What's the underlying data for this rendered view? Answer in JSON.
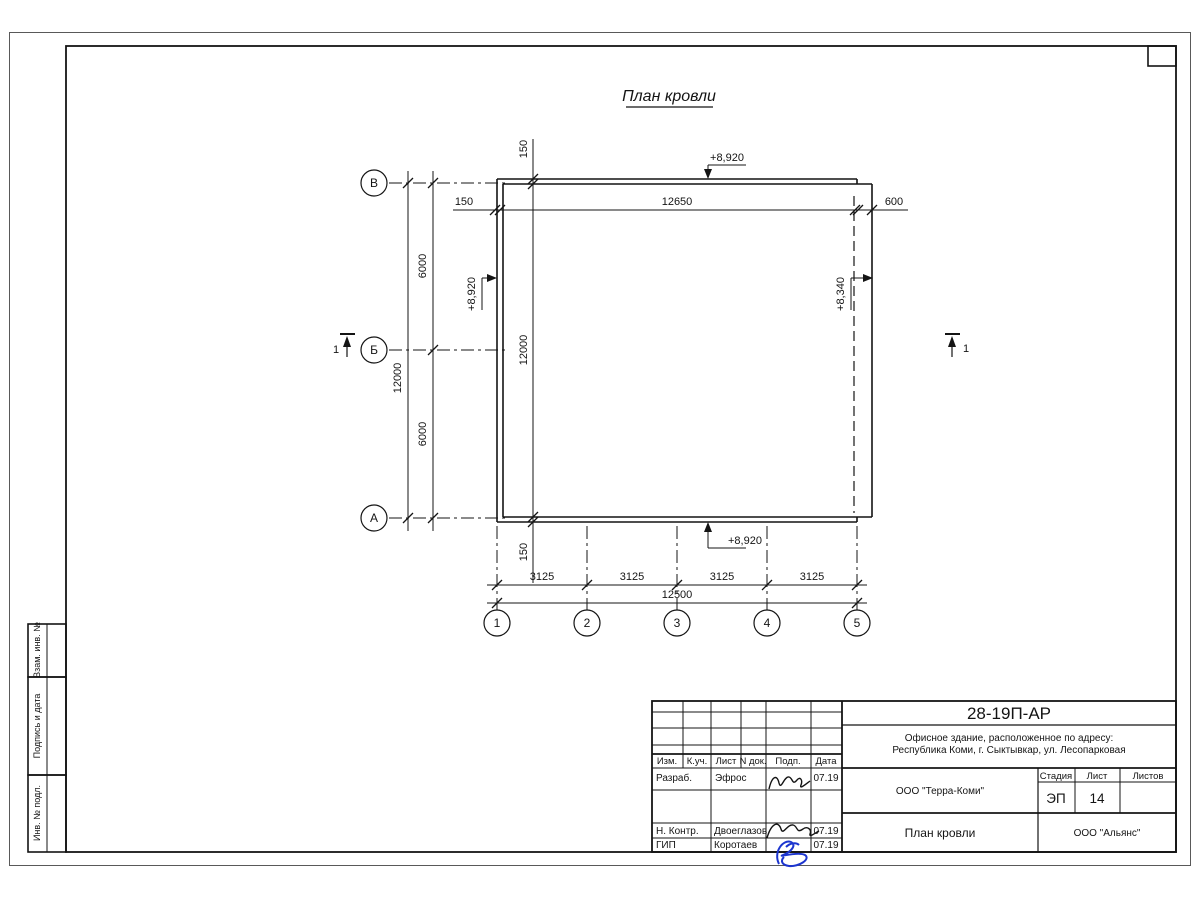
{
  "drawing": {
    "title": "План кровли",
    "row_axes": [
      "В",
      "Б",
      "А"
    ],
    "col_axes": [
      "1",
      "2",
      "3",
      "4",
      "5"
    ],
    "dims": {
      "top": [
        "150",
        "12650",
        "600"
      ],
      "chain": [
        "150",
        "12000",
        "150"
      ],
      "left_spans": [
        "6000",
        "6000"
      ],
      "left_total": "12000",
      "bottom_spans": [
        "3125",
        "3125",
        "3125",
        "3125"
      ],
      "bottom_total": "12500"
    },
    "elevations": {
      "top": "+8,920",
      "bottom": "+8,920",
      "left": "+8,920",
      "right": "+8,340"
    },
    "section_label": "1"
  },
  "side_stamps": [
    "Взам. инв. №",
    "Подпись и дата",
    "Инв. № подл."
  ],
  "title_block": {
    "doc_number": "28-19П-АР",
    "project_address_line1": "Офисное здание, расположенное по адресу:",
    "project_address_line2": "Республика Коми, г. Сыктывкар, ул. Лесопарковая",
    "header_cols": [
      "Изм.",
      "К.уч.",
      "Лист",
      "N док.",
      "Подп.",
      "Дата"
    ],
    "rows": [
      {
        "role": "Разраб.",
        "name": "Эфрос",
        "date": "07.19"
      },
      {
        "role": "Н. Контр.",
        "name": "Двоеглазов",
        "date": "07.19"
      },
      {
        "role": "ГИП",
        "name": "Коротаев",
        "date": "07.19"
      }
    ],
    "designer_company": "ООО \"Терра-Коми\"",
    "stage_label": "Стадия",
    "sheet_label": "Лист",
    "sheets_label": "Листов",
    "stage": "ЭП",
    "sheet": "14",
    "sheets": "",
    "sheet_title": "План кровли",
    "contractor": "ООО \"Альянс\"",
    "accent_signature_color": "#1c35cf"
  }
}
